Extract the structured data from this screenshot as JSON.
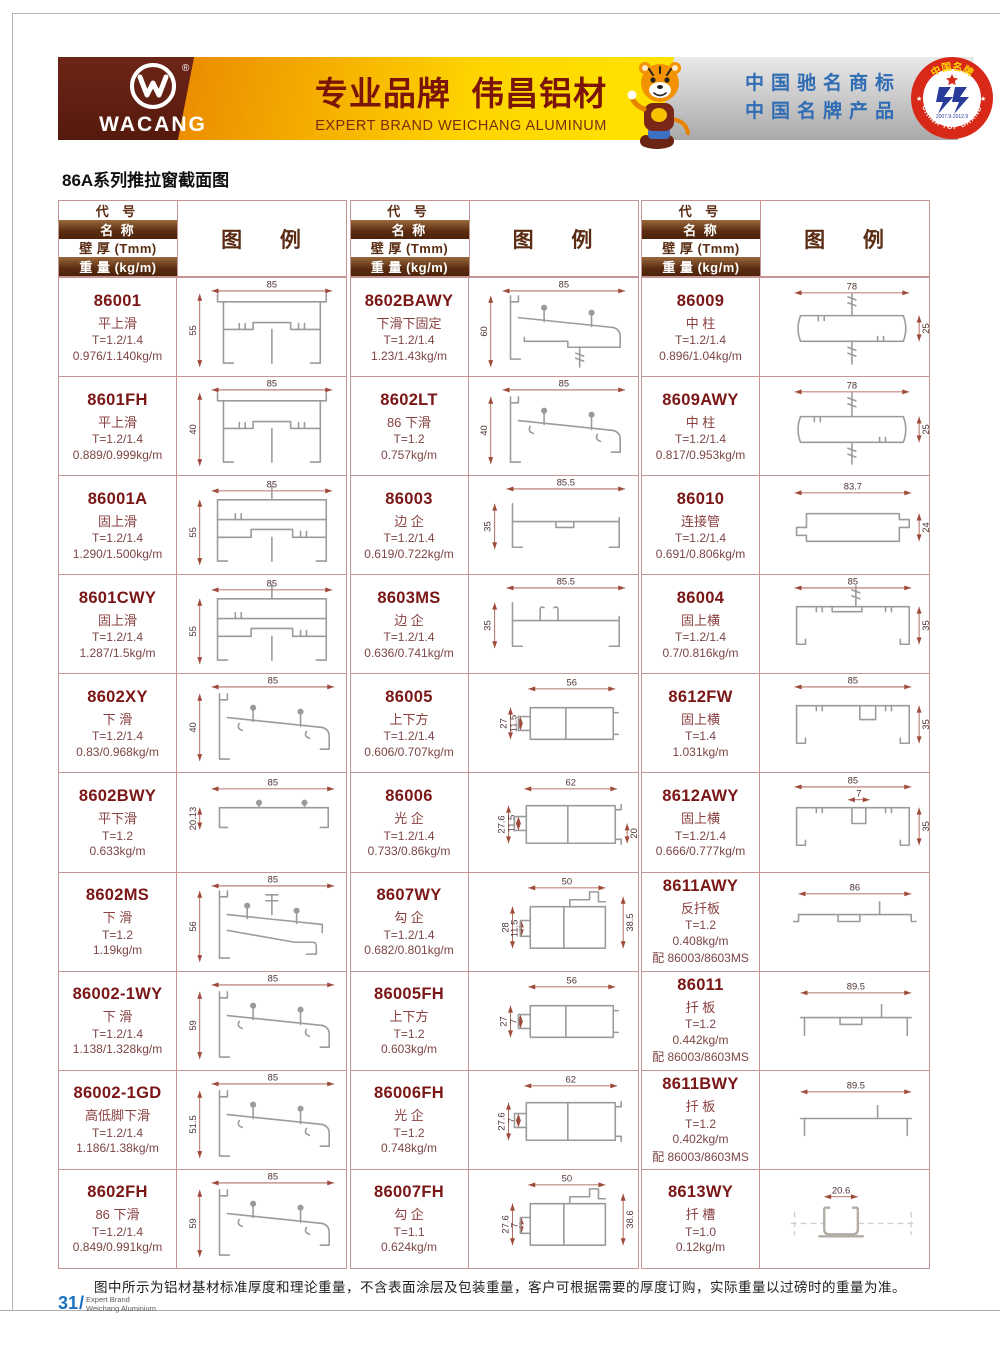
{
  "page": {
    "title": "86A系列推拉窗截面图",
    "footer_note": "图中所示为铝材基材标准厚度和理论重量，不含表面涂层及包装重量，客户可根据需要的厚度订购，实际重量以过磅时的重量为准。",
    "page_number": "31",
    "page_number_slash": "/",
    "footer_brand_line1": "Expert Brand",
    "footer_brand_line2": "Weichang Aluminium"
  },
  "banner": {
    "logo_text": "WACANG",
    "registered_mark": "®",
    "slogan_cn": "专业品牌  伟昌铝材",
    "slogan_en": "EXPERT BRAND WEICHANG ALUMINUM",
    "honor_line1": "中国驰名商标",
    "honor_line2": "中国名牌产品",
    "badge_top": "中国名牌",
    "badge_bottom": "CHINA TOP BRAND",
    "badge_dates": "2007.9-2012.9",
    "colors": {
      "brand_brown": "#5a1d10",
      "brand_yellow": "#ffd500",
      "maroon_text": "#7a1616",
      "honor_blue": "#2f6cb3",
      "badge_red": "#d82818",
      "table_border": "#c59494"
    }
  },
  "table_header": {
    "col1": "代 号",
    "col2": "名 称",
    "col3": "壁 厚 (Tmm)",
    "col4": "重 量 (kg/m)",
    "legend": "图 例"
  },
  "columns": [
    {
      "rows": [
        {
          "code": "86001",
          "name": "平上滑",
          "t": "T=1.2/1.4",
          "w": "0.976/1.140kg/m",
          "shape": "topslide",
          "dims": [
            "85",
            "55"
          ]
        },
        {
          "code": "8601FH",
          "name": "平上滑",
          "t": "T=1.2/1.4",
          "w": "0.889/0.999kg/m",
          "shape": "topslide",
          "dims": [
            "85",
            "40"
          ]
        },
        {
          "code": "86001A",
          "name": "固上滑",
          "t": "T=1.2/1.4",
          "w": "1.290/1.500kg/m",
          "shape": "fixedtopslide",
          "dims": [
            "85",
            "55"
          ]
        },
        {
          "code": "8601CWY",
          "name": "固上滑",
          "t": "T=1.2/1.4",
          "w": "1.287/1.5kg/m",
          "shape": "fixedtopslide",
          "dims": [
            "85",
            "55"
          ]
        },
        {
          "code": "8602XY",
          "name": "下 滑",
          "t": "T=1.2/1.4",
          "w": "0.83/0.968kg/m",
          "shape": "bottomslide",
          "dims": [
            "85",
            "40"
          ]
        },
        {
          "code": "8602BWY",
          "name": "平下滑",
          "t": "T=1.2",
          "w": "0.633kg/m",
          "shape": "flatchannel",
          "dims": [
            "85",
            "20.13"
          ]
        },
        {
          "code": "8602MS",
          "name": "下 滑",
          "t": "T=1.2",
          "w": "1.19kg/m",
          "shape": "bottomslide2",
          "dims": [
            "85",
            "56"
          ]
        },
        {
          "code": "86002-1WY",
          "name": "下 滑",
          "t": "T=1.2/1.4",
          "w": "1.138/1.328kg/m",
          "shape": "bottomslide",
          "dims": [
            "85",
            "59"
          ]
        },
        {
          "code": "86002-1GD",
          "name": "高低脚下滑",
          "t": "T=1.2/1.4",
          "w": "1.186/1.38kg/m",
          "shape": "bottomslide",
          "dims": [
            "85",
            "51.5"
          ]
        },
        {
          "code": "8602FH",
          "name": "86 下滑",
          "t": "T=1.2/1.4",
          "w": "0.849/0.991kg/m",
          "shape": "bottomslide",
          "dims": [
            "85",
            "59"
          ]
        }
      ]
    },
    {
      "rows": [
        {
          "code": "8602BAWY",
          "name": "下滑下固定",
          "t": "T=1.2/1.4",
          "w": "1.23/1.43kg/m",
          "shape": "bottomslide_fixed",
          "dims": [
            "85",
            "60"
          ]
        },
        {
          "code": "8602LT",
          "name": "86 下滑",
          "t": "T=1.2",
          "w": "0.757kg/m",
          "shape": "bottomslide",
          "dims": [
            "85",
            "40"
          ]
        },
        {
          "code": "86003",
          "name": "边 企",
          "t": "T=1.2/1.4",
          "w": "0.619/0.722kg/m",
          "shape": "sidechannel",
          "dims": [
            "85.5",
            "35"
          ]
        },
        {
          "code": "8603MS",
          "name": "边 企",
          "t": "T=1.2/1.4",
          "w": "0.636/0.741kg/m",
          "shape": "sidechannel2",
          "dims": [
            "85.5",
            "35"
          ]
        },
        {
          "code": "86005",
          "name": "上下方",
          "t": "T=1.2/1.4",
          "w": "0.606/0.707kg/m",
          "shape": "tube",
          "dims": [
            "56",
            "27",
            "11.5"
          ]
        },
        {
          "code": "86006",
          "name": "光 企",
          "t": "T=1.2/1.4",
          "w": "0.733/0.86kg/m",
          "shape": "tube2",
          "dims": [
            "62",
            "27.6",
            "11.5",
            "20"
          ]
        },
        {
          "code": "8607WY",
          "name": "勾 企",
          "t": "T=1.2/1.4",
          "w": "0.682/0.801kg/m",
          "shape": "hook",
          "dims": [
            "50",
            "28",
            "11.5",
            "38.5"
          ]
        },
        {
          "code": "86005FH",
          "name": "上下方",
          "t": "T=1.2",
          "w": "0.603kg/m",
          "shape": "tube",
          "dims": [
            "56",
            "27",
            "7"
          ]
        },
        {
          "code": "86006FH",
          "name": "光 企",
          "t": "T=1.2",
          "w": "0.748kg/m",
          "shape": "tube2",
          "dims": [
            "62",
            "27.6",
            "7"
          ]
        },
        {
          "code": "86007FH",
          "name": "勾 企",
          "t": "T=1.1",
          "w": "0.624kg/m",
          "shape": "hook",
          "dims": [
            "50",
            "27.6",
            "7",
            "38.6"
          ]
        }
      ]
    },
    {
      "rows": [
        {
          "code": "86009",
          "name": "中 柱",
          "t": "T=1.2/1.4",
          "w": "0.896/1.04kg/m",
          "shape": "mullion",
          "dims": [
            "78",
            "25"
          ]
        },
        {
          "code": "8609AWY",
          "name": "中 柱",
          "t": "T=1.2/1.4",
          "w": "0.817/0.953kg/m",
          "shape": "mullion2",
          "dims": [
            "78",
            "25"
          ]
        },
        {
          "code": "86010",
          "name": "连接管",
          "t": "T=1.2/1.4",
          "w": "0.691/0.806kg/m",
          "shape": "connector",
          "dims": [
            "83.7",
            "24"
          ]
        },
        {
          "code": "86004",
          "name": "固上横",
          "t": "T=1.2/1.4",
          "w": "0.7/0.816kg/m",
          "shape": "toprail",
          "dims": [
            "85",
            "35"
          ]
        },
        {
          "code": "8612FW",
          "name": "固上横",
          "t": "T=1.4",
          "w": "1.031kg/m",
          "shape": "toprail2",
          "dims": [
            "85",
            "35"
          ]
        },
        {
          "code": "8612AWY",
          "name": "固上横",
          "t": "T=1.2/1.4",
          "w": "0.666/0.777kg/m",
          "shape": "toprail3",
          "dims": [
            "85",
            "7",
            "35"
          ]
        },
        {
          "code": "8611AWY",
          "name": "反扦板",
          "t": "T=1.2",
          "w": "0.408kg/m",
          "match": "配 86003/8603MS",
          "shape": "board",
          "dims": [
            "86"
          ]
        },
        {
          "code": "86011",
          "name": "扦 板",
          "t": "T=1.2",
          "w": "0.442kg/m",
          "match": "配 86003/8603MS",
          "shape": "board2",
          "dims": [
            "89.5"
          ]
        },
        {
          "code": "8611BWY",
          "name": "扦 板",
          "t": "T=1.2",
          "w": "0.402kg/m",
          "match": "配 86003/8603MS",
          "shape": "board3",
          "dims": [
            "89.5"
          ]
        },
        {
          "code": "8613WY",
          "name": "扦 槽",
          "t": "T=1.0",
          "w": "0.12kg/m",
          "shape": "slot",
          "dims": [
            "20.6"
          ]
        }
      ]
    }
  ]
}
